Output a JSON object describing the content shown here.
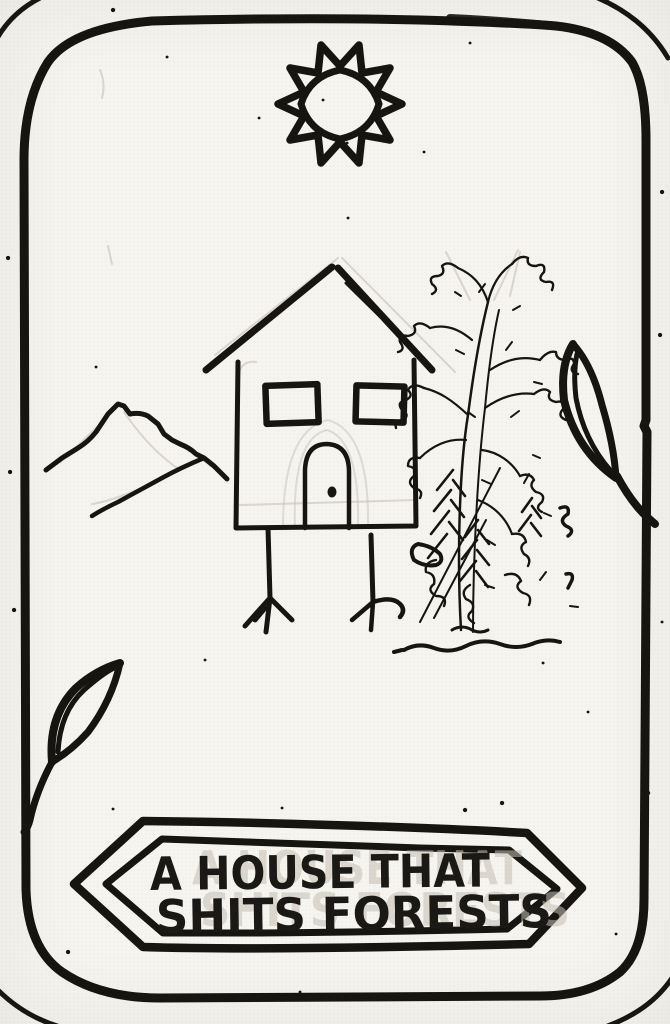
{
  "banner": {
    "title_line1": "A HOUSE THAT",
    "title_line2": "SHITS FORESTS",
    "ghost_line1": "A HOUSE THAT",
    "ghost_line2": "SHITS FORESTS"
  },
  "card": {
    "elements": {
      "sun": "sun-flower-drawing",
      "house": "house-on-bird-legs-drawing",
      "mountain": "mountain-ridge-drawing",
      "tree": "scribbled-tree-drawing",
      "leaf_right": "leaf-right-border-drawing",
      "leaf_bottom_left": "leaf-bottom-left-drawing",
      "banner": "pointed-ribbon-banner"
    },
    "colors": {
      "ink": "#171512",
      "paper": "#f6f4ef",
      "pencil": "#c2bcb1"
    }
  }
}
